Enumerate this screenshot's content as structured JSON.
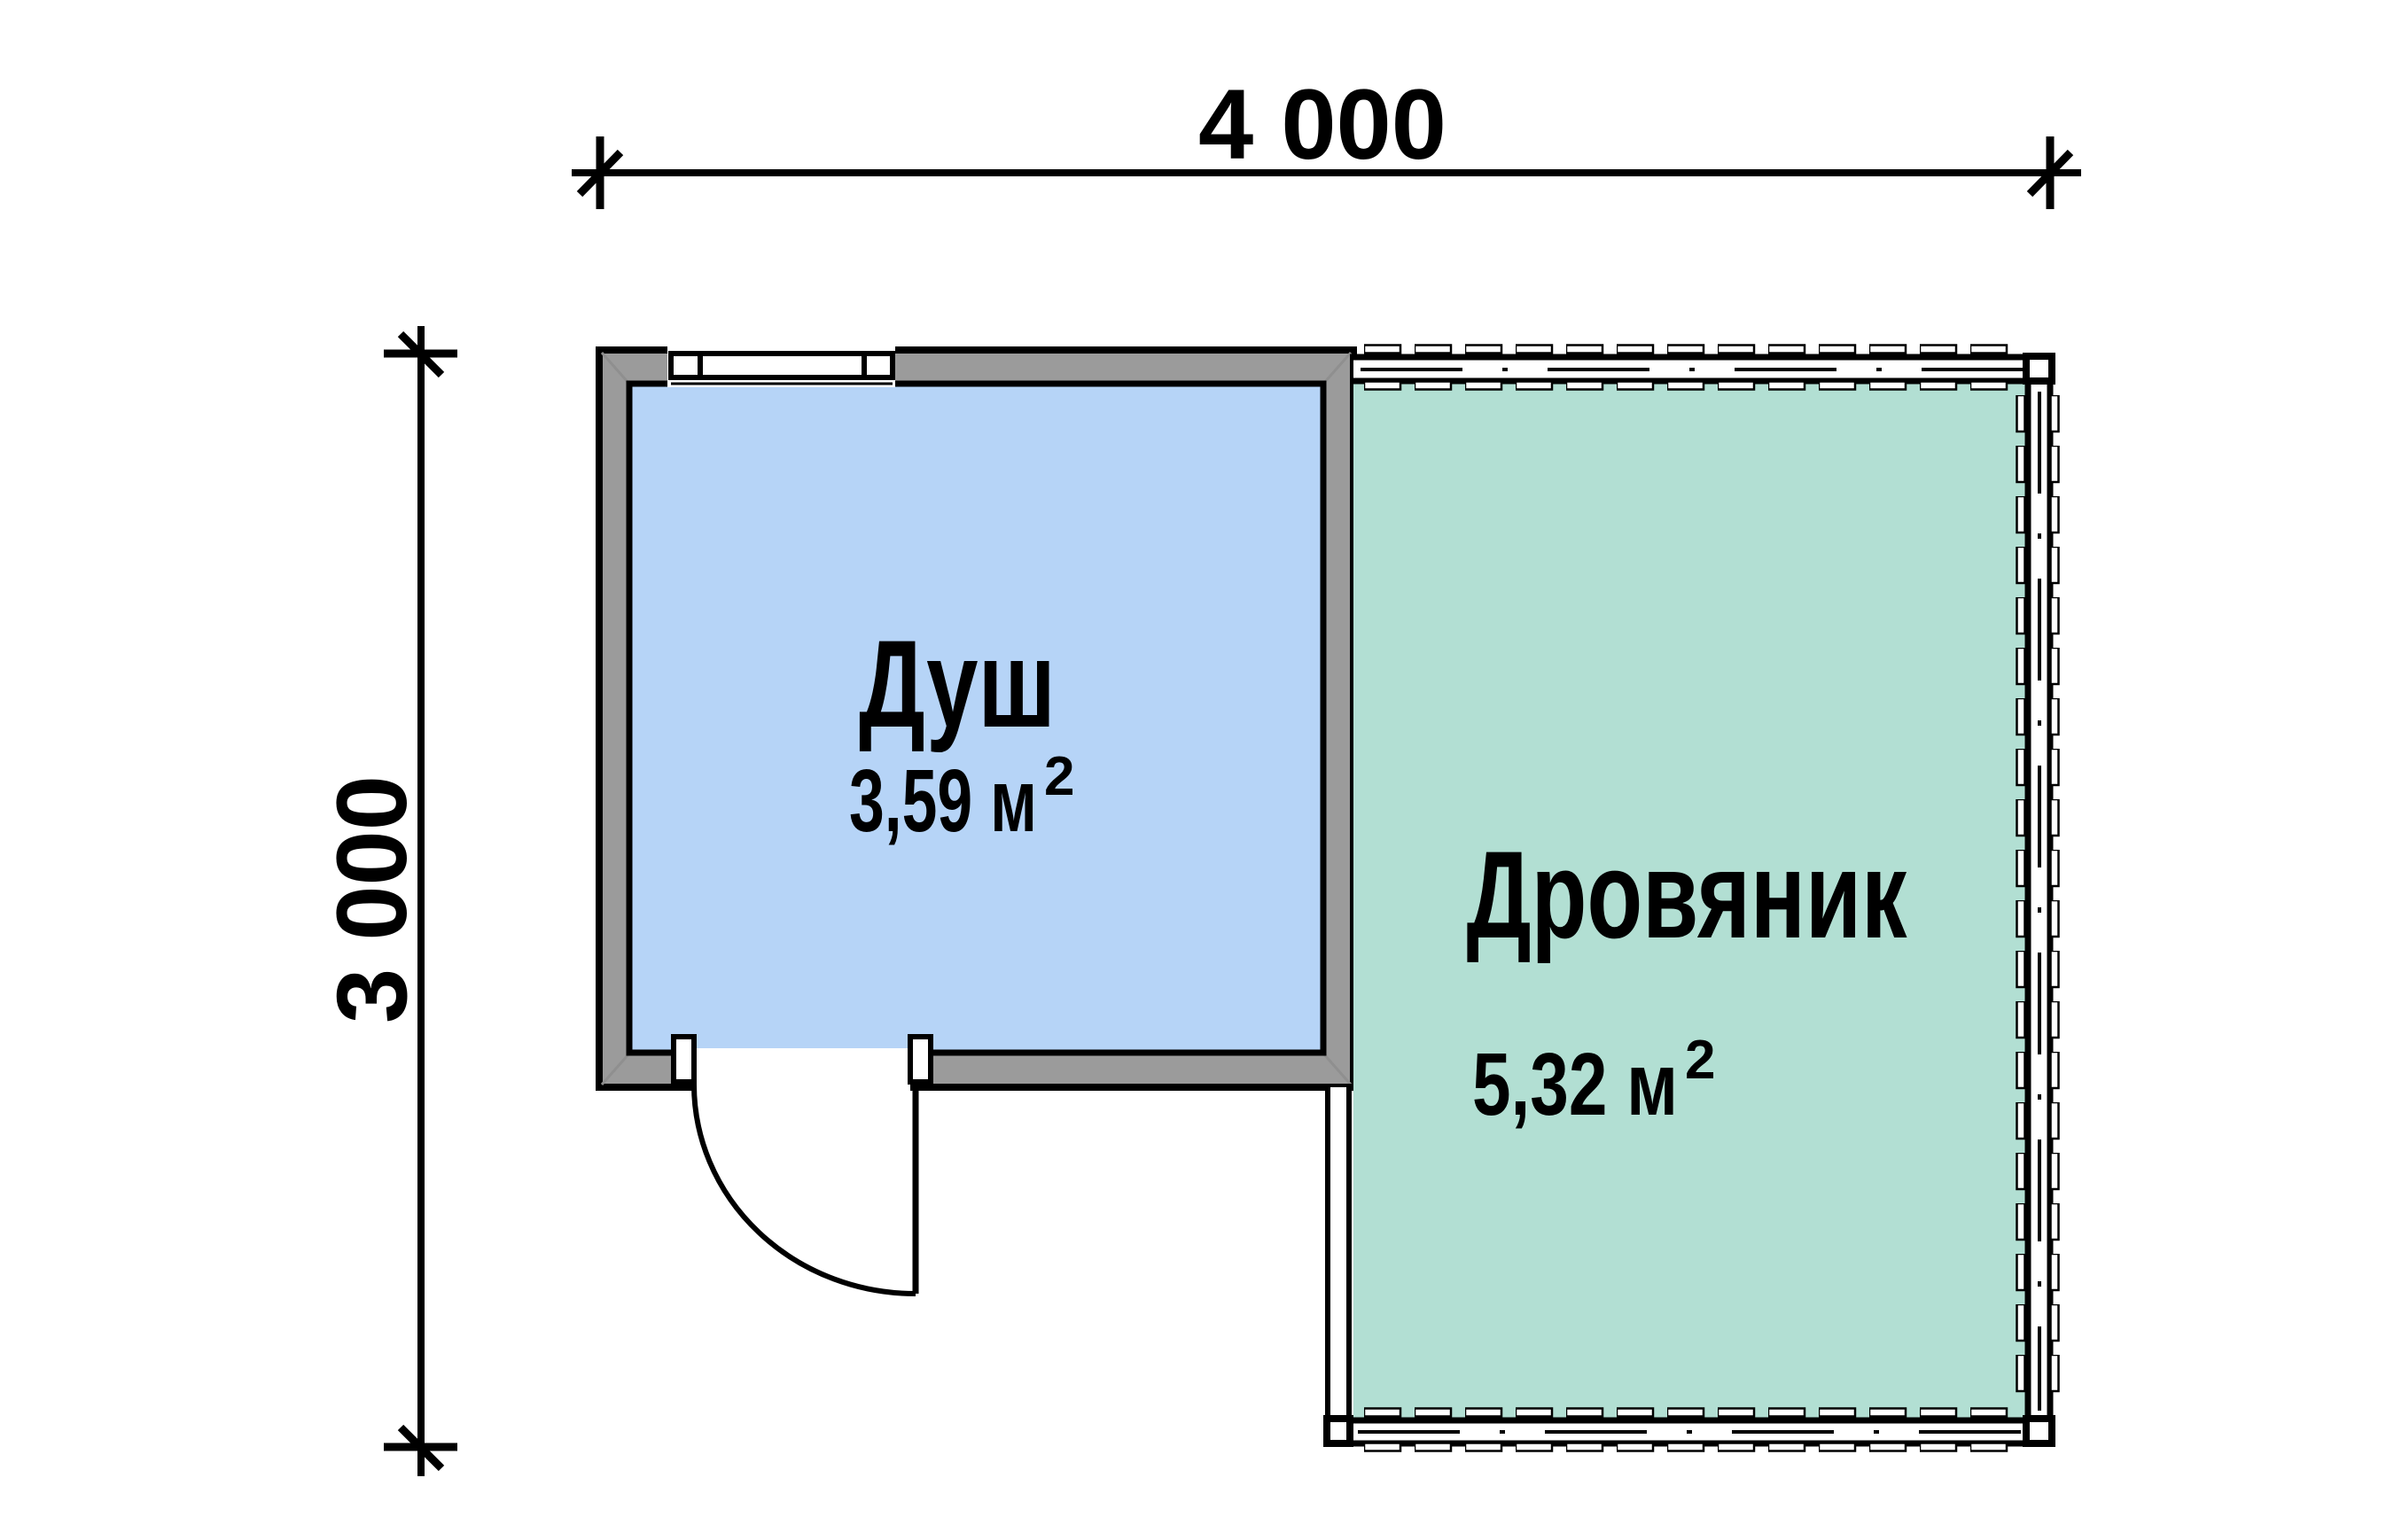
{
  "plan_title": "Floor plan: shower and woodshed outbuilding",
  "dimensions": {
    "width_label": "4 000",
    "height_label": "3 000"
  },
  "rooms": [
    {
      "name": "Душ",
      "area_value": "3,59 м",
      "area_sup": "2",
      "fill": "#b6d4f7"
    },
    {
      "name": "Дровяник",
      "area_value": "5,32 м",
      "area_sup": "2",
      "fill": "#b2dfd3"
    }
  ],
  "colors": {
    "wall_gray": "#9b9b9b",
    "outline_black": "#000000",
    "miter_gray": "#8f8f8f",
    "paper_white": "#ffffff"
  }
}
